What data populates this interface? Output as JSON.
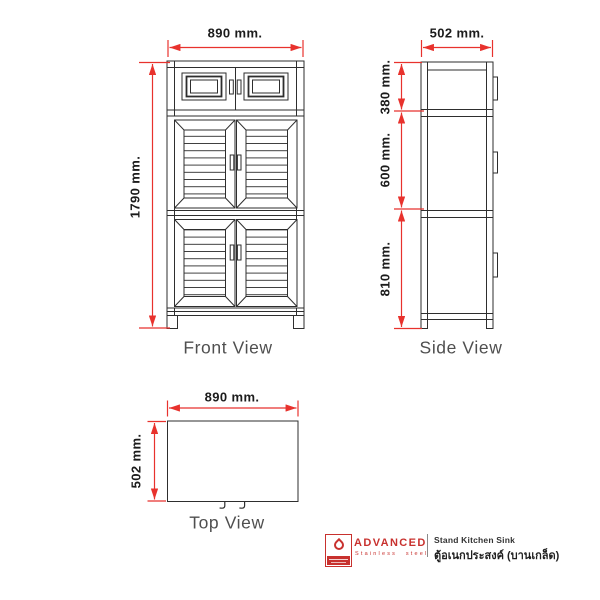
{
  "front_view": {
    "label": "Front View",
    "width": "890 mm.",
    "height": "1790 mm."
  },
  "side_view": {
    "label": "Side View",
    "depth": "502 mm.",
    "section_top": "380 mm.",
    "section_middle": "600 mm.",
    "section_bottom": "810 mm."
  },
  "top_view": {
    "label": "Top View",
    "width": "890 mm.",
    "depth": "502 mm."
  },
  "footer": {
    "brand": "ADVANCED",
    "brand_tagline": "Stainless steel",
    "product_name_en": "Stand Kitchen Sink",
    "product_name_th": "ตู้อเนกประสงค์ (บานเกล็ด)"
  },
  "colors": {
    "dimension_red": "#e8322d",
    "drawing_line": "#2e2e2e",
    "label_gray": "#4f4f4f",
    "brand_red": "#c8312e"
  }
}
